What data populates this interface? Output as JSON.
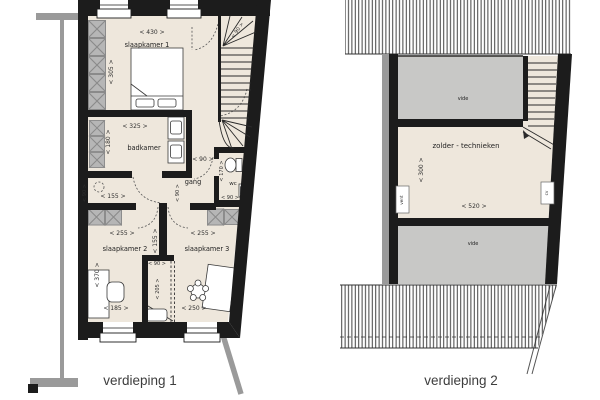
{
  "floor1": {
    "caption": "verdieping 1",
    "rooms": {
      "bedroom1": "slaapkamer 1",
      "bathroom": "badkamer",
      "hall": "gang",
      "wc": "wc",
      "bedroom2": "slaapkamer 2",
      "bedroom3": "slaapkamer 3"
    },
    "dims": {
      "bedroom1_width": "< 430 >",
      "bedroom1_depth": "< 305 >",
      "stair_width": "< 90 >",
      "bathroom_width": "< 325 >",
      "bathroom_depth": "< 180 >",
      "hall_width": "< 90 >",
      "hall_depth": "< 90 >",
      "wc_depth": "< 170 >",
      "wc_width": "< 90 >",
      "landing_depth": "< 90 >",
      "landing_width": "< 155 >",
      "bedroom2_width": "< 255 >",
      "bedroom3_width": "< 255 >",
      "center_clearance": "< 155 >",
      "bedroom2_depth": "< 370 >",
      "bedroom2_bottom_width": "< 185 >",
      "closet_width": "< 90 >",
      "closet_depth": "< 205 >",
      "bedroom3_bottom_width": "< 250 >"
    }
  },
  "floor2": {
    "caption": "verdieping 2",
    "rooms": {
      "void_top": "vide",
      "attic": "zolder - technieken",
      "void_bottom": "vide"
    },
    "equipment": {
      "vent": "vent",
      "cv": "cv"
    },
    "dims": {
      "attic_depth": "< 300 >",
      "attic_width": "< 520 >"
    }
  },
  "colors": {
    "floor": "#eee7dc",
    "void_gray": "#c8c8c6",
    "duct_gray": "#b6b6b6",
    "wall_black": "#1c1c1c",
    "neighbor_gray": "#9a9a9a"
  }
}
